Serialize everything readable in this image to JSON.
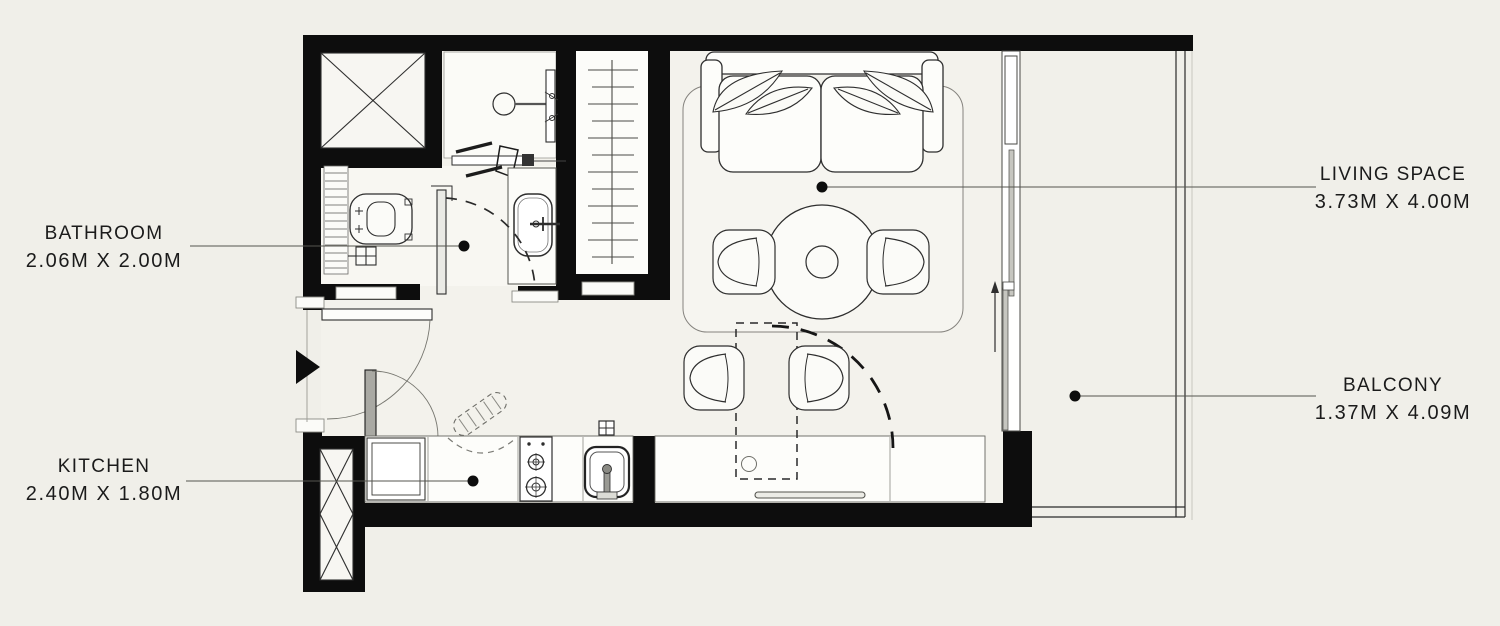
{
  "canvas": {
    "background": "#f0efe9",
    "wall_color": "#0d0d0d",
    "line_color": "#3a3a3a",
    "text_color": "#1b1b1b"
  },
  "rooms": [
    {
      "key": "bathroom",
      "label": "BATHROOM",
      "dimensions": "2.06M X 2.00M"
    },
    {
      "key": "kitchen",
      "label": "KITCHEN",
      "dimensions": "2.40M X 1.80M"
    },
    {
      "key": "living_space",
      "label": "LIVING SPACE",
      "dimensions": "3.73M X 4.00M"
    },
    {
      "key": "balcony",
      "label": "BALCONY",
      "dimensions": "1.37M X 4.09M"
    }
  ],
  "plan_symbols": [
    "duct-shaft",
    "shower",
    "toilet",
    "bathroom-vanity",
    "wardrobe",
    "entry-arrow",
    "door-swing",
    "sofa",
    "rug",
    "round-dining-table",
    "dining-chair",
    "foldable-table",
    "kitchen-counter",
    "fridge",
    "stove",
    "kitchen-sink",
    "sliding-balcony-door",
    "balcony-railing"
  ]
}
